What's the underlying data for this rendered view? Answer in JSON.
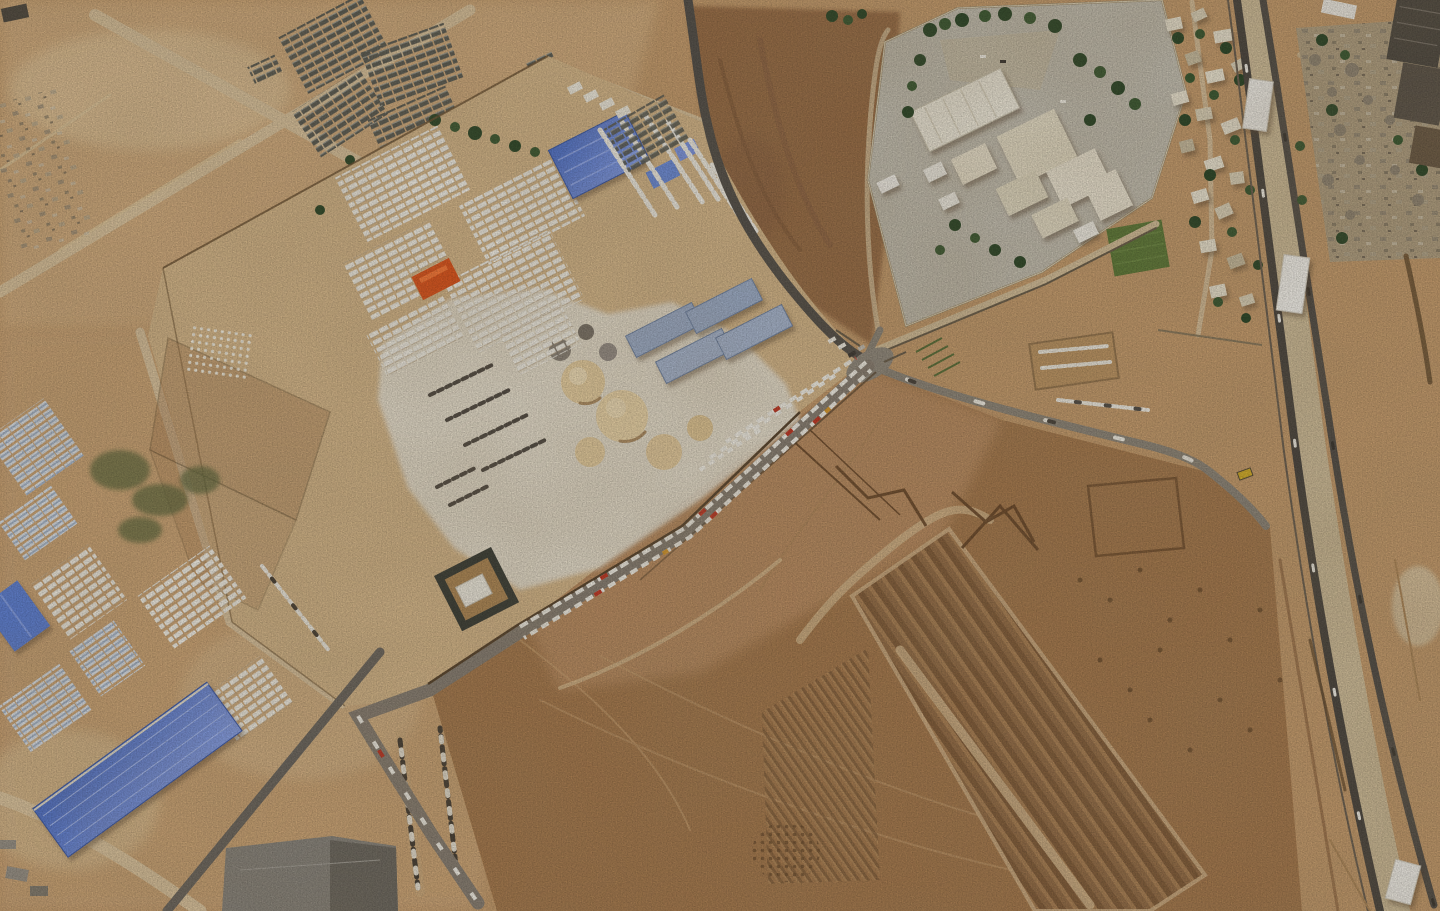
{
  "meta": {
    "type": "satellite-photograph",
    "subject": "Overhead satellite view of a desert border-crossing area with a long queue of aid trucks, walled logistics compounds, warehouses and excavated earthworks",
    "orientation": "overhead, no visible text or UI elements",
    "sun": "low sun from the east casting short shadows west of buildings"
  },
  "palette": {
    "sand_base": "#c79e6f",
    "sand_light": "#d3ae80",
    "sand_pale": "#e3c99f",
    "dirt_brown": "#9b6f48",
    "field_brown": "#a87c50",
    "field_light": "#c09367",
    "road_dirt": "#ddc6a0",
    "road_paved": "#8a8377",
    "asphalt": "#514c45",
    "wall": "#6b5334",
    "concrete_pad": "#e9e2d2",
    "apron_gray": "#c5c0b2",
    "building_cream": "#e9e1cb",
    "building_white": "#f2efe6",
    "blue_roof": "#5f82d8",
    "bluegray_roof": "#9fb0cc",
    "tree_green": "#2f4a2b",
    "field_green": "#5f7c3a",
    "orange_tarps": "#e0561e",
    "truck_white": "#f2efe6",
    "truck_red": "#c23b28",
    "tent_gray": "#5d5e56",
    "paved_yard": "#8b877f"
  },
  "features": [
    {
      "name": "tent-clusters-top-left",
      "description": "irregular clusters of dark gray tents/solar panels scattered over light sand"
    },
    {
      "name": "dirt-roads-top-left",
      "description": "pale dirt roads crossing the upper-left quadrant diagonally"
    },
    {
      "name": "logistics-compound",
      "description": "large tilted walled compound with rows of white shipping containers and tents"
    },
    {
      "name": "orange-tarp-cluster",
      "description": "small bright orange tarp stack among the container rows"
    },
    {
      "name": "compound-blue-warehouse",
      "description": "large blue-roofed warehouse near the compound's north wall"
    },
    {
      "name": "bluegray-sheds",
      "description": "two pairs of long blue-gray roofed sheds east of the concrete pad"
    },
    {
      "name": "concrete-pad",
      "description": "white concrete working area with sand and gravel stockpiles"
    },
    {
      "name": "sand-piles",
      "description": "pale sand and aggregate mounds on the concrete pad"
    },
    {
      "name": "pallet-rows",
      "description": "rows of dark pallets/cargo staged on the pad"
    },
    {
      "name": "truck-rows-annex",
      "description": "diagonal rows of parked white trucks in the compound's north annex"
    },
    {
      "name": "fort-structure",
      "description": "small square dark-walled enclosure with a white building inside, beside the road"
    },
    {
      "name": "truck-queue-road",
      "description": "gray road running diagonally with a long double queue of white trucks, several red/orange ones mixed in, fanning into extra rows near the junction"
    },
    {
      "name": "junction-gate",
      "description": "road junction and wall gate where the queue meets the crossing road"
    },
    {
      "name": "hospital-complex",
      "description": "walled complex of cream and white buildings on gray paved aprons with many dark green trees"
    },
    {
      "name": "green-field",
      "description": "small bright green irrigated field at the complex's east side"
    },
    {
      "name": "village-strip",
      "description": "small white houses and trees between the complex and the border road"
    },
    {
      "name": "border-roads",
      "description": "two parallel dark asphalt border roads running from top to bottom-right"
    },
    {
      "name": "white-hangars",
      "description": "white arched hangars sitting between the border roads"
    },
    {
      "name": "rubble-field",
      "description": "demolished buildings and gray rubble with trees east of the border road"
    },
    {
      "name": "dark-warehouses-corner",
      "description": "large dark-roofed warehouse buildings in the top-right corner"
    },
    {
      "name": "excavated-field",
      "description": "large brown bulldozed field occupying the bottom-right with track marks"
    },
    {
      "name": "terraced-excavation",
      "description": "long terraced excavation strip with parallel dark furrows"
    },
    {
      "name": "trench-chevrons",
      "description": "zigzag and rectangular trench outlines dug into the brown field"
    },
    {
      "name": "mound-dots",
      "description": "grid of small excavated mounds near the field's west edge"
    },
    {
      "name": "parked-truck-columns",
      "description": "two columns of trucks parked in the dirt south of the queue"
    },
    {
      "name": "greenhouse-arrays",
      "description": "blue-white striped greenhouse/solar arrays along the left edge"
    },
    {
      "name": "container-yards-southwest",
      "description": "white container storage yards in the lower-left"
    },
    {
      "name": "blue-warehouse-large",
      "description": "very large blue-roofed warehouse in the bottom-left"
    },
    {
      "name": "blue-warehouse-small",
      "description": "smaller blue-roofed building at the left edge"
    },
    {
      "name": "paved-yard",
      "description": "dark gray paved yard at the bottom edge"
    },
    {
      "name": "truck-enclosures-east",
      "description": "rows of trucks parked inside dirt enclosures east of the junction"
    },
    {
      "name": "crop-rows",
      "description": "few short green crop rows north of the junction"
    }
  ]
}
